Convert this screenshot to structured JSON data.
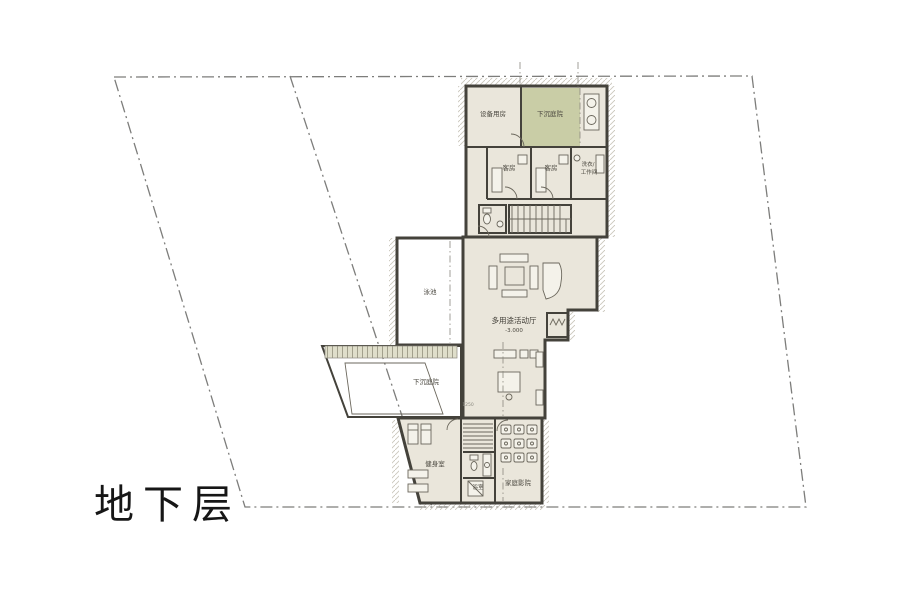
{
  "plan": {
    "title": "地下层",
    "labels": {
      "equipment_room": "设备用房",
      "sunken_courtyard_top": "下沉庭院",
      "guest_room_1": "客房",
      "guest_room_2": "客房",
      "laundry_line1": "洗衣/",
      "laundry_line2": "工作间",
      "pool": "泳池",
      "hall": "多用途活动厅",
      "hall_level": "-3.000",
      "sunken_courtyard_left": "下沉庭院",
      "gym": "健身室",
      "bath": "浴室",
      "home_theater": "家庭影院",
      "dimension": "1250"
    },
    "colors": {
      "floor": "#eae6db",
      "courtyard_green": "#c9cda6",
      "pool_blue": "#d2e1e3",
      "wall": "#44423b",
      "site_boundary": "#7d7d7b",
      "hatch": "#c2beb1",
      "text": "#4a473f"
    }
  }
}
